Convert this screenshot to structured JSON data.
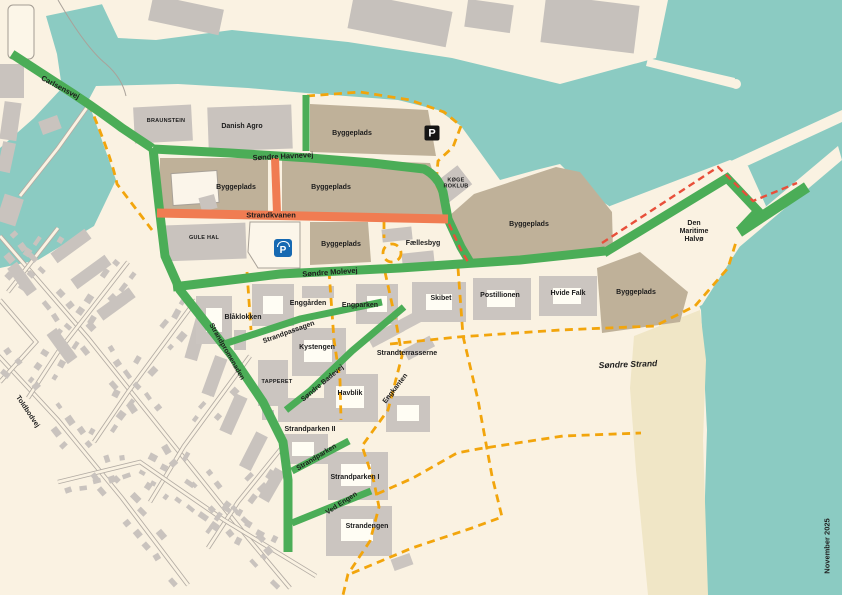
{
  "labels": {
    "carlsensvej": "Carlsensvej",
    "braunstein": "BRAUNSTEIN",
    "danish_agro": "Danish Agro",
    "byggeplads": "Byggeplads",
    "sondre_havnevej": "Søndre Havnevej",
    "strandkvanen": "Strandkvanen",
    "gule_hal": "GULE HAL",
    "koge_roklub": "KØGE\nROKLUB",
    "faellesbyg": "Fællesbyg",
    "sondre_molevej": "Søndre Molevej",
    "den_maritime_halvo": "Den\nMaritime\nHalvø",
    "skibet": "Skibet",
    "postillionen": "Postillionen",
    "hvide_falk": "Hvide Falk",
    "enggarden": "Enggården",
    "engparken": "Engparken",
    "blaklokken": "Blåklokken",
    "strandpassagen": "Strandpassagen",
    "kystengen": "Kystengen",
    "strandterrasserne": "Strandterrasserne",
    "tapperet": "TAPPERET",
    "sondre_badevej": "Søndre Badevej",
    "havblik": "Havblik",
    "engkanten": "Engkanten",
    "strandpromenaden": "Strandpromenaden",
    "toldbodvej": "Toldbodvej",
    "strandparken_ii": "Strandparken II",
    "strandparken_road": "Strandparken",
    "strandparken_i": "Strandparken I",
    "ved_engen": "Ved Engen",
    "strandengen": "Strandengen",
    "sondre_strand": "Søndre Strand",
    "date_note": "November 2025"
  },
  "icons": {
    "parking_letter": "P"
  },
  "colors": {
    "water": "#8BCBC2",
    "land": "#FAF2E2",
    "sand": "#F0E6C6",
    "construction_site": "#BFB199",
    "building": "#CBC5C0",
    "green_route": "#4BAD57",
    "closed_route_orange": "#F07C52",
    "path_dashed_yellow": "#F2A50C",
    "path_dashed_red": "#E84F3A",
    "parking_blue": "#1669B2",
    "parking_black": "#151515"
  }
}
